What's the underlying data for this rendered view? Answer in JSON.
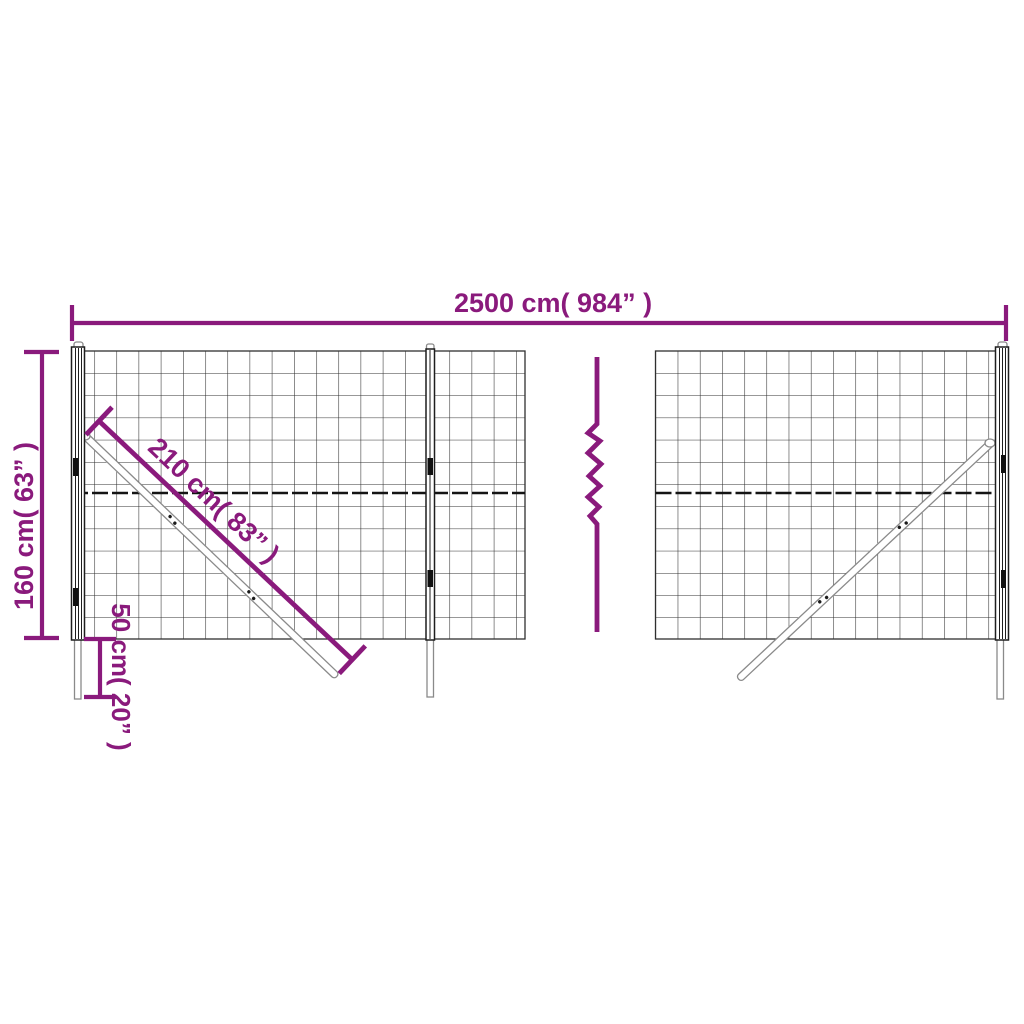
{
  "colors": {
    "accent": "#8a1a7c",
    "mesh": "#2f2f2f",
    "metal": "#8a8a8a",
    "dark": "#1e1e1e",
    "background": "#ffffff"
  },
  "diagram": {
    "labels": {
      "total_width": "2500 cm( 984” )",
      "height": "160 cm( 63” )",
      "brace_length": "210 cm( 83” )",
      "ground_depth": "50 cm( 20” )"
    }
  }
}
